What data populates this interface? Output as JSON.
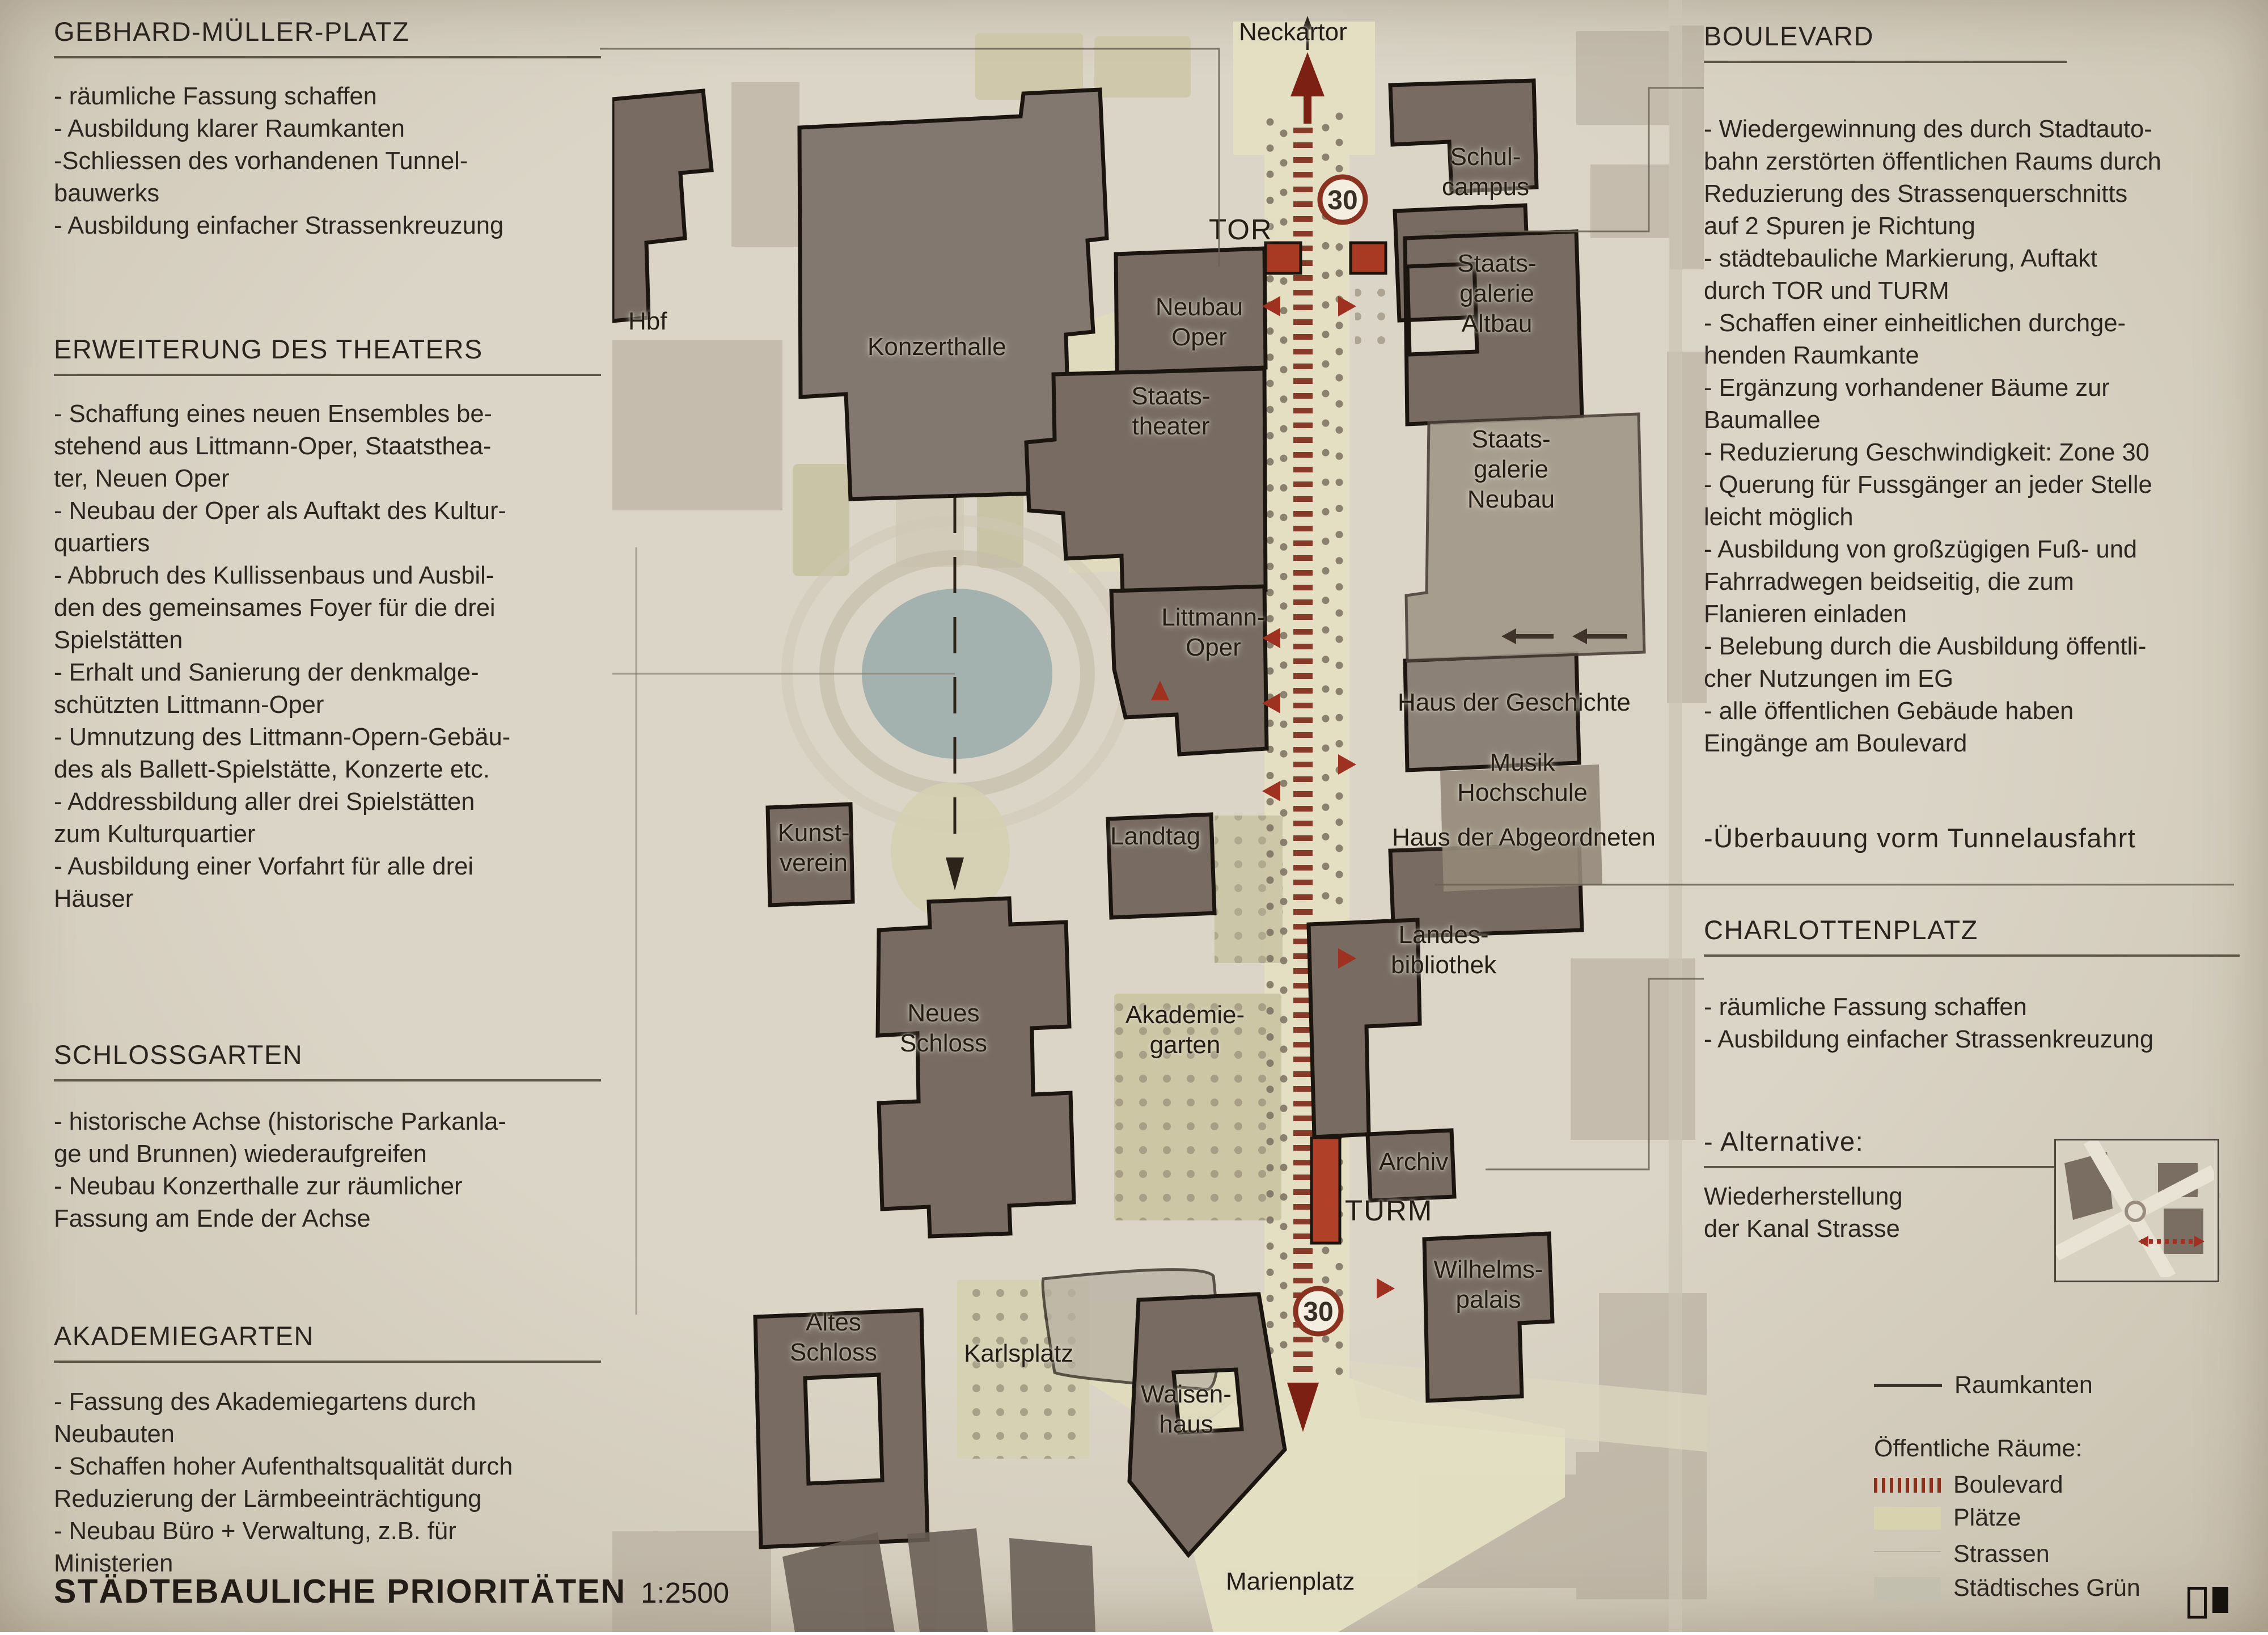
{
  "footer": {
    "title": "STÄDTEBAULICHE PRIORITÄTEN",
    "scale": "1:2500"
  },
  "left": {
    "sections": [
      {
        "heading": "GEBHARD-MÜLLER-PLATZ",
        "lines": [
          "- räumliche Fassung schaffen",
          "- Ausbildung klarer Raumkanten",
          "-Schliessen des vorhandenen Tunnel-",
          "bauwerks",
          "- Ausbildung einfacher Strassenkreuzung"
        ]
      },
      {
        "heading": "ERWEITERUNG DES THEATERS",
        "lines": [
          "- Schaffung eines neuen Ensembles be-",
          "stehend aus Littmann-Oper, Staatsthea-",
          "ter, Neuen Oper",
          "- Neubau der Oper als Auftakt des Kultur-",
          "quartiers",
          "- Abbruch des Kullissenbaus und Ausbil-",
          "den des gemeinsames Foyer für die drei",
          "Spielstätten",
          "- Erhalt und Sanierung der denkmalge-",
          "schützten Littmann-Oper",
          "- Umnutzung des Littmann-Opern-Gebäu-",
          "des als Ballett-Spielstätte, Konzerte etc.",
          "- Addressbildung aller drei Spielstätten",
          "zum Kulturquartier",
          "- Ausbildung einer Vorfahrt für alle drei",
          "Häuser"
        ]
      },
      {
        "heading": "SCHLOSSGARTEN",
        "lines": [
          "- historische Achse (historische Parkanla-",
          "ge und Brunnen) wiederaufgreifen",
          "- Neubau Konzerthalle zur räumlicher",
          "Fassung am Ende der Achse"
        ]
      },
      {
        "heading": "AKADEMIEGARTEN",
        "lines": [
          "- Fassung des Akademiegartens durch",
          "Neubauten",
          "- Schaffen hoher Aufenthaltsqualität durch",
          "Reduzierung der Lärmbeeinträchtigung",
          "- Neubau Büro + Verwaltung, z.B. für",
          "Ministerien"
        ]
      }
    ]
  },
  "right": {
    "sections": [
      {
        "heading": "BOULEVARD",
        "lines": [
          "- Wiedergewinnung des durch Stadtauto-",
          "bahn zerstörten öffentlichen Raums durch",
          "Reduzierung des Strassenquerschnitts",
          "auf 2 Spuren je Richtung",
          "- städtebauliche Markierung, Auftakt",
          "durch TOR und TURM",
          "- Schaffen einer einheitlichen durchge-",
          "henden Raumkante",
          "- Ergänzung vorhandener Bäume zur",
          "Baumallee",
          "- Reduzierung Geschwindigkeit: Zone 30",
          "- Querung für Fussgänger an jeder Stelle",
          "leicht möglich",
          "- Ausbildung von großzügigen Fuß- und",
          "Fahrradwegen beidseitig, die zum",
          "Flanieren einladen",
          "- Belebung durch die Ausbildung öffentli-",
          "cher Nutzungen im EG",
          "- alle öffentlichen Gebäude haben",
          "Eingänge am Boulevard"
        ]
      },
      {
        "heading": "-Überbauung vorm Tunnelausfahrt",
        "lines": []
      },
      {
        "heading": "CHARLOTTENPLATZ",
        "lines": [
          "- räumliche Fassung schaffen",
          "- Ausbildung einfacher Strassenkreuzung"
        ]
      },
      {
        "heading": "- Alternative:",
        "lines": [
          "Wiederherstellung",
          "der Kanal Strasse"
        ]
      }
    ]
  },
  "legend": {
    "raumkanten": "Raumkanten",
    "heading": "Öffentliche Räume:",
    "items": [
      {
        "label": "Boulevard"
      },
      {
        "label": "Plätze"
      },
      {
        "label": "Strassen"
      },
      {
        "label": "Städtisches Grün"
      }
    ]
  },
  "map": {
    "zone30": "30",
    "labels": {
      "hbf": "Hbf",
      "konzerthalle": "Konzerthalle",
      "neckartor": "Neckartor",
      "schulcampus": "Schul-\ncampus",
      "tor": "TOR",
      "neubau_oper": "Neubau\nOper",
      "sg_altbau": "Staats-\ngalerie\nAltbau",
      "staatstheater": "Staats-\ntheater",
      "sg_neubau": "Staats-\ngalerie\nNeubau",
      "littmann": "Littmann-\nOper",
      "hdg": "Haus der Geschichte",
      "musik": "Musik\nHochschule",
      "hda": "Haus der Abgeordneten",
      "kunstverein": "Kunst-\nverein",
      "landtag": "Landtag",
      "landesbib": "Landes-\nbibliothek",
      "neues_schloss": "Neues\nSchloss",
      "akademiegarten": "Akademie-\ngarten",
      "archiv": "Archiv",
      "turm": "TURM",
      "wilhelms": "Wilhelms-\npalais",
      "altes_schloss": "Altes\nSchloss",
      "karlsplatz": "Karlsplatz",
      "waisenhaus": "Waisen-\nhaus",
      "marienplatz": "Marienplatz"
    }
  },
  "colors": {
    "accent_red": "#a03122",
    "dark_red": "#7b2013",
    "boulevard_beige": "#e4dfc2",
    "building_dark": "#776b62",
    "lake_blue": "#a3b2ae",
    "paper": "#d5cec0"
  }
}
